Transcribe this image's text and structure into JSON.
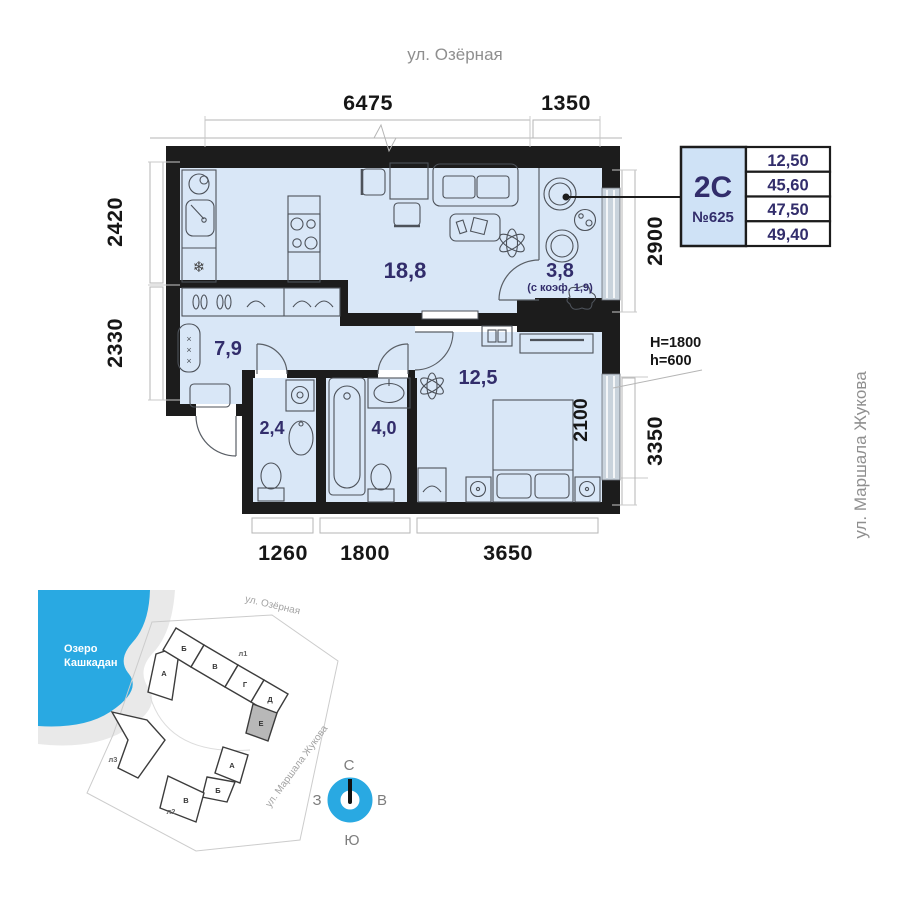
{
  "plan": {
    "street_top": "ул. Озёрная",
    "street_right": "ул. Маршала Жукова",
    "dims": {
      "top": [
        "6475",
        "1350"
      ],
      "left": [
        "2420",
        "2330"
      ],
      "right": [
        "2900",
        "3350"
      ],
      "bottom": [
        "1260",
        "1800",
        "3650"
      ],
      "bedroom_window_width": "2100"
    },
    "window_note": {
      "height": "H=1800",
      "sill": "h=600"
    },
    "rooms": {
      "living_kitchen": "18,8",
      "balcony": "3,8",
      "balcony_note": "(с коэф. 1,9)",
      "hall": "7,9",
      "wc": "2,4",
      "bathroom": "4,0",
      "bedroom": "12,5"
    },
    "unit_card": {
      "type": "2С",
      "number": "№625",
      "areas": [
        "12,50",
        "45,60",
        "47,50",
        "49,40"
      ]
    }
  },
  "sitemap": {
    "lake_line1": "Озеро",
    "lake_line2": "Кашкадан",
    "street_top": "ул. Озёрная",
    "street_right": "ул. Маршала Жукова",
    "upper_blocks": [
      "А",
      "Б",
      "В",
      "Г",
      "Д",
      "Е"
    ],
    "lower_blocks": [
      "А",
      "Б",
      "В"
    ],
    "towers": [
      "л1",
      "л2",
      "л3"
    ],
    "highlighted_block": "Е"
  },
  "compass": {
    "north": "С",
    "south": "Ю",
    "west": "З",
    "east": "В"
  },
  "icons": {
    "fridge_snowflake": "❄",
    "radiator_marks": "×"
  },
  "colors": {
    "accent_blue": "#29a9e2",
    "room_fill": "#d9e7f7",
    "wall": "#1c1c1c",
    "navy_text": "#322d6b",
    "card_fill": "#cfe2f6"
  }
}
